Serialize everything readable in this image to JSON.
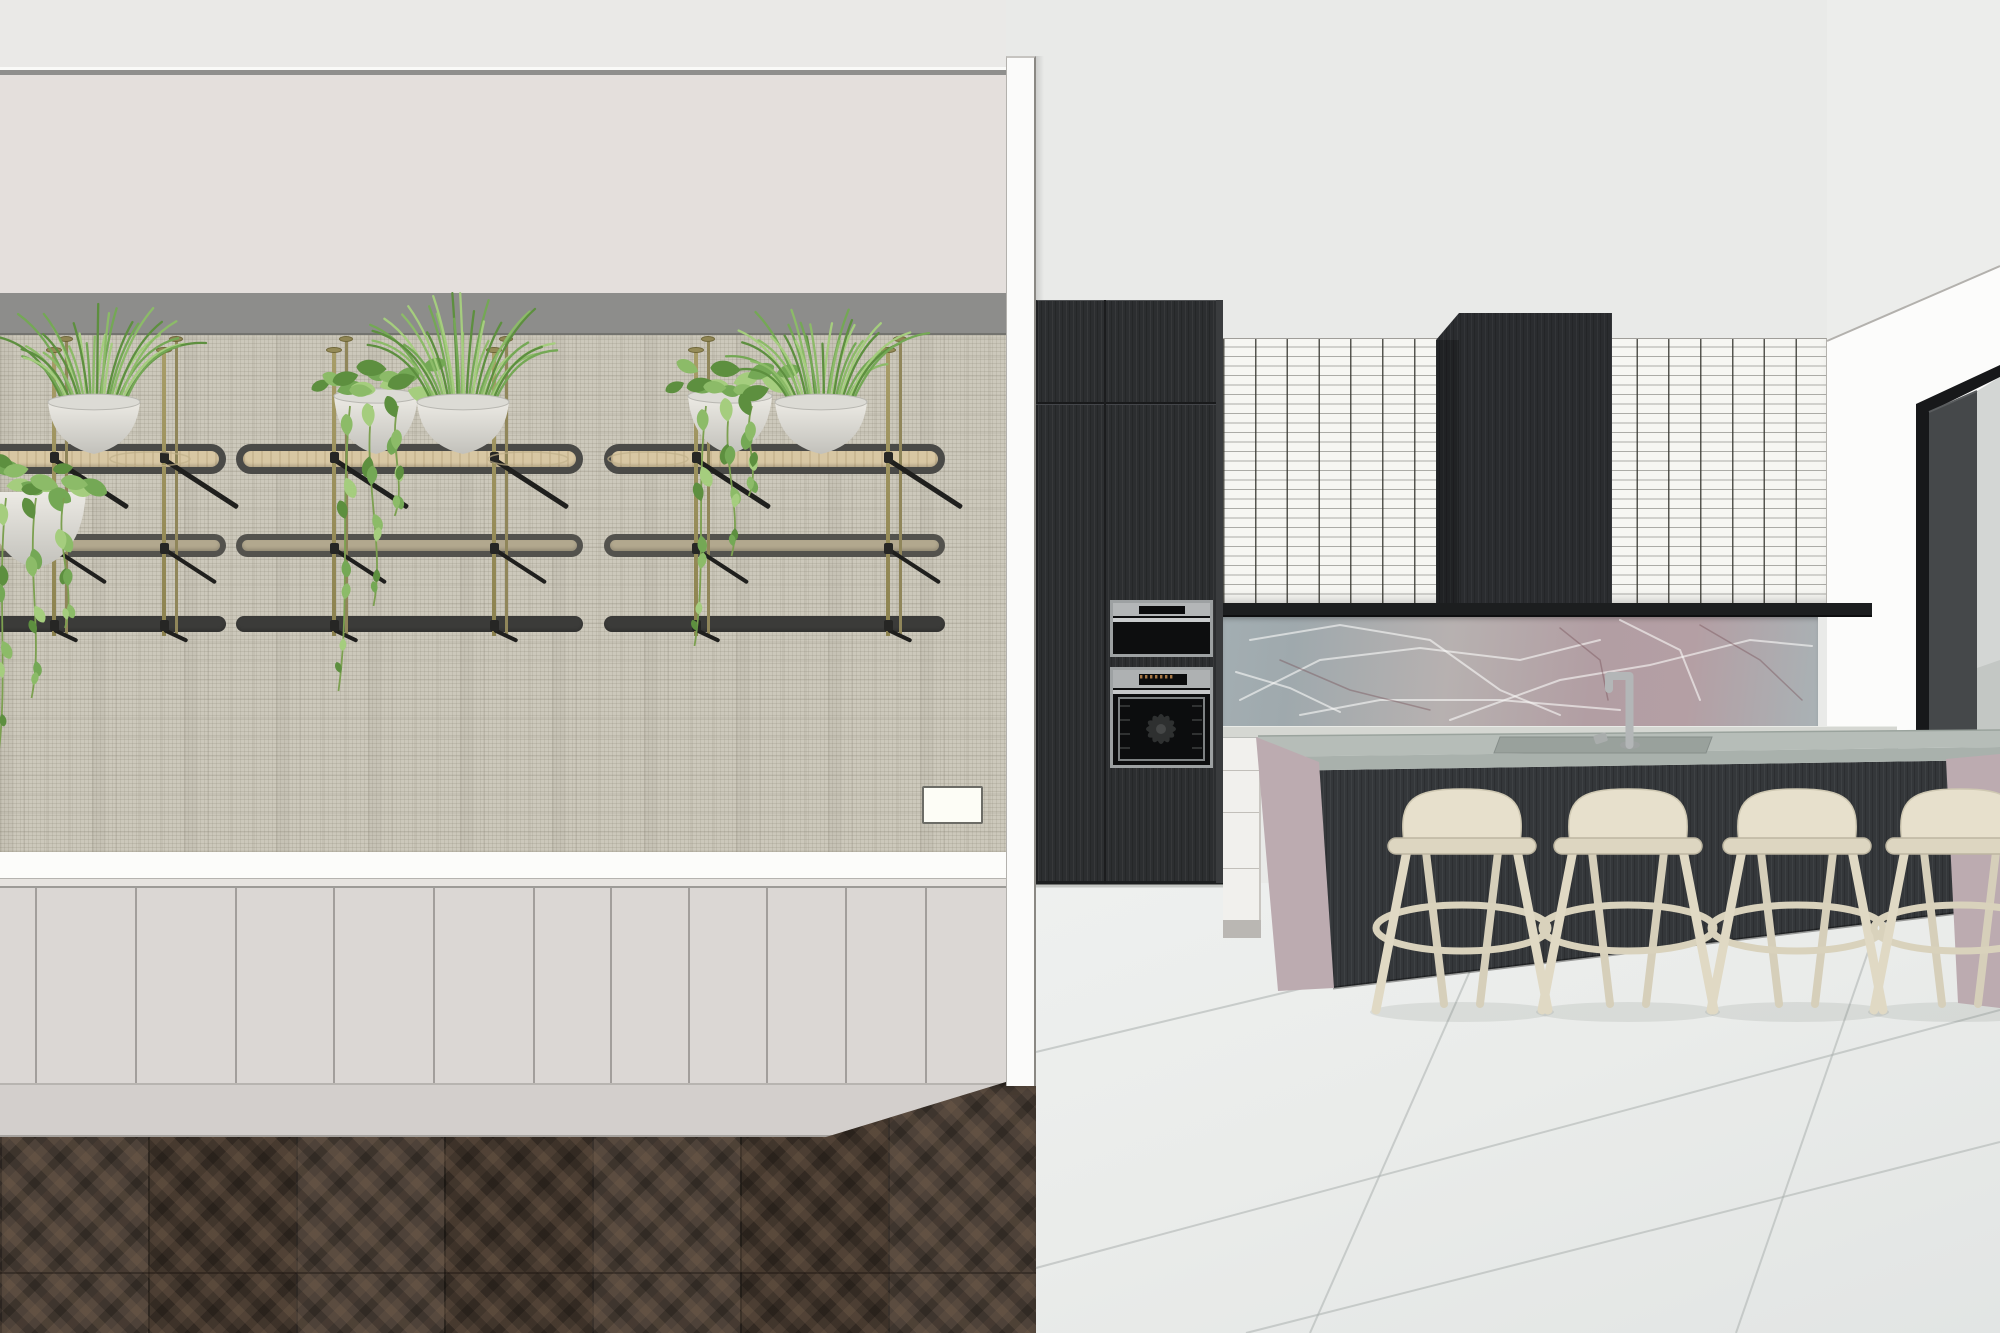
{
  "meta": {
    "title": "3D interior render - kitchen with dark cabinetry, marble island and plant shelving wall",
    "canvas": {
      "w": 2000,
      "h": 1333
    }
  },
  "palette": {
    "kitchenWall": "#e9eae8",
    "leftCeiling": "#eae9e7",
    "ceilLineLight": "#fafaf8",
    "ceilLineGrey": "#8f8f8d",
    "upperWall": "#e4dfdc",
    "soffit": "#8d8d8b",
    "soffitEdge": "#73736f",
    "texWallBase": "#ccc8bb",
    "counterBandWhite": "#fcfcfa",
    "counterEdge": "#e6e3df",
    "cabinetFace": "#dbd7d4",
    "cabinetSeam": "#a29e9b",
    "plinth": "#d3cfcc",
    "leftFloorBase": "#463a30",
    "dividerFace": "#fbfbfa",
    "whiteWall": "#fcfcfb",
    "ceilSlope": "#ecedeb",
    "tileBase": "#f6f6f2",
    "darkCabinet": "#2c2e30",
    "hood": "#2a2c2f",
    "blackShelf": "#1c1e1f",
    "marbleA": "#a3aeb2",
    "marbleB": "#b7b1b0",
    "marbleC": "#b29ea3",
    "marbleD": "#a9b2b5",
    "counterTop": "#d5d7d2",
    "drawerWhite": "#f1f0ed",
    "islandTop": "#b6bdb8",
    "islandEdge": "#a9b1ac",
    "islandBase": "#34373a",
    "waterfallMarble": "#bcabb0",
    "stoolBody": "#e7e0cc",
    "stoolLeg": "#e0d9c4",
    "stoolRing": "#d9d2bc",
    "kitchenFloor": "#eaecea",
    "windowFrame": "#17181a",
    "windowJamb": "#45484a",
    "glass": "#d3d6d4",
    "glassLower": "#c3c7c4",
    "steel": "#b3b6b7",
    "ovenBlack": "#0d0e0f",
    "brassPole": "#9a8f5e",
    "shelfBrace": "#1f1f1d",
    "potLight": "#eceae4",
    "potShade": "#c2c1bb",
    "green1": "#5d8f3f",
    "green2": "#74a855",
    "green3": "#8cbb68",
    "green4": "#a5cd7e"
  },
  "left_room": {
    "cabinet_seams": [
      35,
      135,
      235,
      333,
      433,
      533,
      610,
      688,
      766,
      845,
      925
    ],
    "switch": {
      "x": 922,
      "y": 786,
      "w": 61,
      "h": 38
    },
    "shelf_levels": [
      {
        "name": "top",
        "y": 444,
        "h": 30,
        "rim": "#4a4a47",
        "fill": "#d8c7a3",
        "radius": 16,
        "border": 7
      },
      {
        "name": "middle",
        "y": 534,
        "h": 23,
        "rim": "#53524d",
        "fill": "#b2a88e",
        "radius": 12,
        "border": 6
      },
      {
        "name": "bottom",
        "y": 616,
        "h": 16,
        "rim": "#3b3b39",
        "fill": "#3b3b39",
        "radius": 8,
        "border": 0
      }
    ],
    "shelf_units": [
      {
        "x0": -80,
        "x1": 226,
        "poles": [
          52,
          162
        ]
      },
      {
        "x0": 236,
        "x1": 583,
        "poles": [
          332,
          492
        ]
      },
      {
        "x0": 604,
        "x1": 945,
        "poles": [
          694,
          886
        ]
      }
    ],
    "pole_top": 338,
    "pole_bottom": 632,
    "plate_rings": [
      150,
      528,
      648
    ],
    "plants": [
      {
        "type": "pothos-bowl",
        "cx": 36,
        "rimY": 492,
        "vines": [
          {
            "dx": -30,
            "len": 265
          },
          {
            "dx": 0,
            "len": 200
          },
          {
            "dx": 28,
            "len": 130
          }
        ]
      },
      {
        "type": "herb",
        "cx": 94,
        "baseY": 452
      },
      {
        "type": "pothos",
        "cx": 376,
        "baseY": 452,
        "vines": [
          {
            "dx": -26,
            "len": 285
          },
          {
            "dx": -4,
            "len": 200
          },
          {
            "dx": 22,
            "len": 110
          }
        ]
      },
      {
        "type": "herb",
        "cx": 463,
        "baseY": 452
      },
      {
        "type": "pothos",
        "cx": 730,
        "baseY": 452,
        "vines": [
          {
            "dx": -24,
            "len": 240
          },
          {
            "dx": 0,
            "len": 150
          },
          {
            "dx": 22,
            "len": 90
          }
        ]
      },
      {
        "type": "herb",
        "cx": 821,
        "baseY": 452
      }
    ]
  },
  "kitchen": {
    "ceiling_line": [
      1827,
      341,
      2000,
      266
    ],
    "stool_centers": [
      1462,
      1628,
      1797,
      1960
    ],
    "stool": {
      "backTop": 789,
      "seatY": 838,
      "ringY": 928,
      "floorY": 1010
    },
    "marble_veins_light": [
      [
        1240,
        700,
        1320,
        660,
        1420,
        648,
        1520,
        660,
        1600,
        640
      ],
      [
        1250,
        640,
        1340,
        625,
        1430,
        640,
        1500,
        690,
        1560,
        715
      ],
      [
        1450,
        720,
        1560,
        680,
        1650,
        665,
        1750,
        640,
        1812,
        646
      ],
      [
        1300,
        715,
        1380,
        700,
        1500,
        700,
        1620,
        710
      ],
      [
        1620,
        620,
        1680,
        650,
        1700,
        700
      ],
      [
        1236,
        672,
        1290,
        688,
        1340,
        712
      ]
    ],
    "marble_veins_dark": [
      [
        1700,
        625,
        1760,
        660,
        1802,
        700
      ],
      [
        1280,
        660,
        1350,
        690,
        1430,
        710
      ],
      [
        1560,
        628,
        1600,
        660,
        1608,
        700
      ]
    ],
    "waterfall_veins": [
      [
        1268,
        800,
        1300,
        860,
        1292,
        930
      ],
      [
        1282,
        772,
        1320,
        820,
        1326,
        880
      ],
      [
        1274,
        940,
        1310,
        968
      ],
      [
        1962,
        800,
        1986,
        880
      ],
      [
        1958,
        950,
        1992,
        992
      ]
    ],
    "island_top_streaks": [
      [
        1300,
        746,
        1720,
        739
      ],
      [
        1430,
        752,
        1905,
        745
      ],
      [
        1560,
        742,
        1980,
        736
      ]
    ],
    "floor_seams": [
      [
        1036,
        1052,
        1680,
        898
      ],
      [
        1036,
        1268,
        2000,
        1010
      ],
      [
        1246,
        1333,
        2000,
        1142
      ],
      [
        1500,
        903,
        1310,
        1333
      ],
      [
        1886,
        900,
        1736,
        1333
      ]
    ]
  }
}
